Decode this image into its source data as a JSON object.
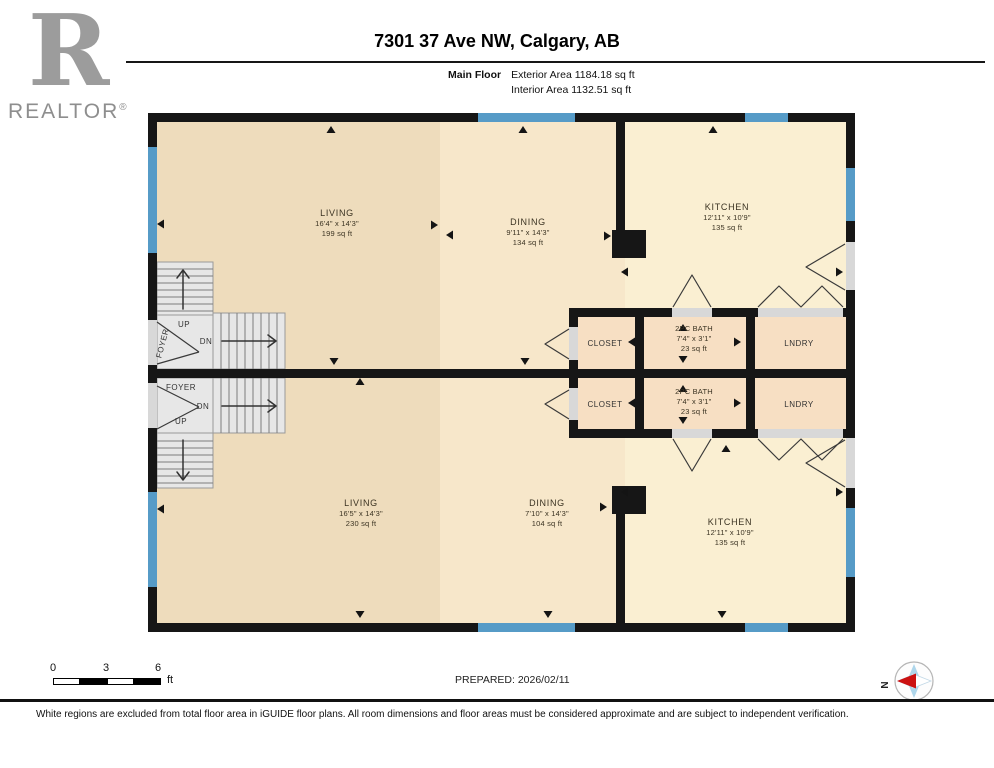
{
  "header": {
    "logo": {
      "r": "R",
      "text": "REALTOR",
      "reg": "®"
    },
    "title": "7301 37 Ave NW, Calgary, AB",
    "floor_label": "Main Floor",
    "exterior_area": "Exterior Area 1184.18 sq ft",
    "interior_area": "Interior Area 1132.51 sq ft"
  },
  "plan": {
    "upper_unit": {
      "living": {
        "name": "LIVING",
        "dims": "16'4\" x 14'3\"",
        "area": "199 sq ft"
      },
      "dining": {
        "name": "DINING",
        "dims": "9'11\" x 14'3\"",
        "area": "134 sq ft"
      },
      "kitchen": {
        "name": "KITCHEN",
        "dims": "12'11\" x 10'9\"",
        "area": "135 sq ft"
      },
      "bath": {
        "name": "2PC BATH",
        "dims": "7'4\" x 3'1\"",
        "area": "23 sq ft"
      },
      "closet": {
        "name": "CLOSET"
      },
      "laundry": {
        "name": "LNDRY"
      },
      "foyer": {
        "name": "FOYER",
        "up": "UP",
        "down": "DN"
      }
    },
    "lower_unit": {
      "living": {
        "name": "LIVING",
        "dims": "16'5\" x 14'3\"",
        "area": "230 sq ft"
      },
      "dining": {
        "name": "DINING",
        "dims": "7'10\" x 14'3\"",
        "area": "104 sq ft"
      },
      "kitchen": {
        "name": "KITCHEN",
        "dims": "12'11\" x 10'9\"",
        "area": "135 sq ft"
      },
      "bath": {
        "name": "2PC BATH",
        "dims": "7'4\" x 3'1\"",
        "area": "23 sq ft"
      },
      "closet": {
        "name": "CLOSET"
      },
      "laundry": {
        "name": "LNDRY"
      },
      "foyer": {
        "name": "FOYER",
        "up": "UP",
        "down": "DN"
      }
    }
  },
  "footer": {
    "scale": {
      "tick0": "0",
      "tick3": "3",
      "tick6": "6",
      "unit": "ft"
    },
    "prepared": "PREPARED: 2026/02/11",
    "compass_label": "N",
    "disclaimer": "White regions are excluded from total floor area in iGUIDE floor plans. All room dimensions and floor areas must be considered approximate and are subject to independent verification."
  },
  "colors": {
    "wall": "#161616",
    "window": "#569bc7",
    "door_gap": "#d8d8d8",
    "living": "#eedcbc",
    "dining": "#f7e7ca",
    "kitchen": "#faefd2",
    "utility": "#f7dfc3",
    "stairs": "#e7e7e7",
    "accent_red": "#cc1111",
    "compass_blue": "#aed6eb"
  }
}
